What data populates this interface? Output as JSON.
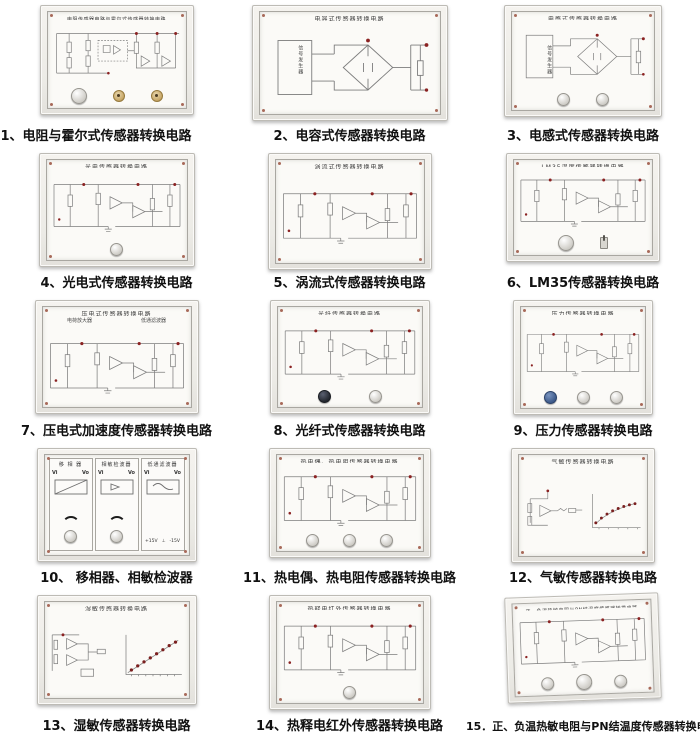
{
  "page": {
    "background": "#ffffff",
    "caption_color": "#111111",
    "accent_red": "#8b2222",
    "board_frame": "#efede9",
    "panel_face": "#fbfaf7",
    "schematic_line": "#7d7d7d",
    "knob_blue": "#3d5a8a",
    "knob_dark": "#23272e",
    "socket_brass": "#c9a96a"
  },
  "panels": [
    {
      "board_title": "电阻传感器电路与霍尔式传感器转换电路",
      "caption": "1、电阻与霍尔式传感器转换电路"
    },
    {
      "board_title": "电容式传感器转换电路",
      "box_label": "信号发生器",
      "caption": "2、电容式传感器转换电路"
    },
    {
      "board_title": "电感式传感器转换电路",
      "box_label": "信号发生器",
      "caption": "3、电感式传感器转换电路"
    },
    {
      "board_title": "光电传感器转换电路",
      "caption": "4、光电式传感器转换电路"
    },
    {
      "board_title": "涡流式传感器转换电路",
      "caption": "5、涡流式传感器转换电路"
    },
    {
      "board_title": "LM35温度传感器转换电路",
      "caption": "6、LM35传感器转换电路"
    },
    {
      "board_title": "压电式传感器转换电路",
      "sub_left": "电荷放大器",
      "sub_right": "低通滤波器",
      "caption": "7、压电式加速度传感器转换电路"
    },
    {
      "board_title": "光纤传感器转换电路",
      "caption": "8、光纤式传感器转换电路"
    },
    {
      "board_title": "压力传感器转换电路",
      "caption": "9、压力传感器转换电路"
    },
    {
      "sections": [
        "移 相 器",
        "相敏检波器",
        "低通滤波器"
      ],
      "vi": "Vi",
      "vo": "Vo",
      "pos": "+15V",
      "gnd": "⊥",
      "neg": "-15V",
      "caption": "10、 移相器、相敏检波器"
    },
    {
      "board_title": "热电偶、热电阻传感器转换电路",
      "caption": "11、热电偶、热电阻传感器转换电路"
    },
    {
      "board_title": "气敏传感器转换电路",
      "caption": "12、气敏传感器转换电路"
    },
    {
      "board_title": "湿敏传感器转换电路",
      "caption": "13、湿敏传感器转换电路"
    },
    {
      "board_title": "热释电红外传感器转换电路",
      "caption": "14、热释电红外传感器转换电路"
    },
    {
      "board_title": "正、负温热敏电阻与PN结温度传感器转换电路",
      "caption": "15．正、负温热敏电阻与PN结温度传感器转换电路"
    }
  ]
}
